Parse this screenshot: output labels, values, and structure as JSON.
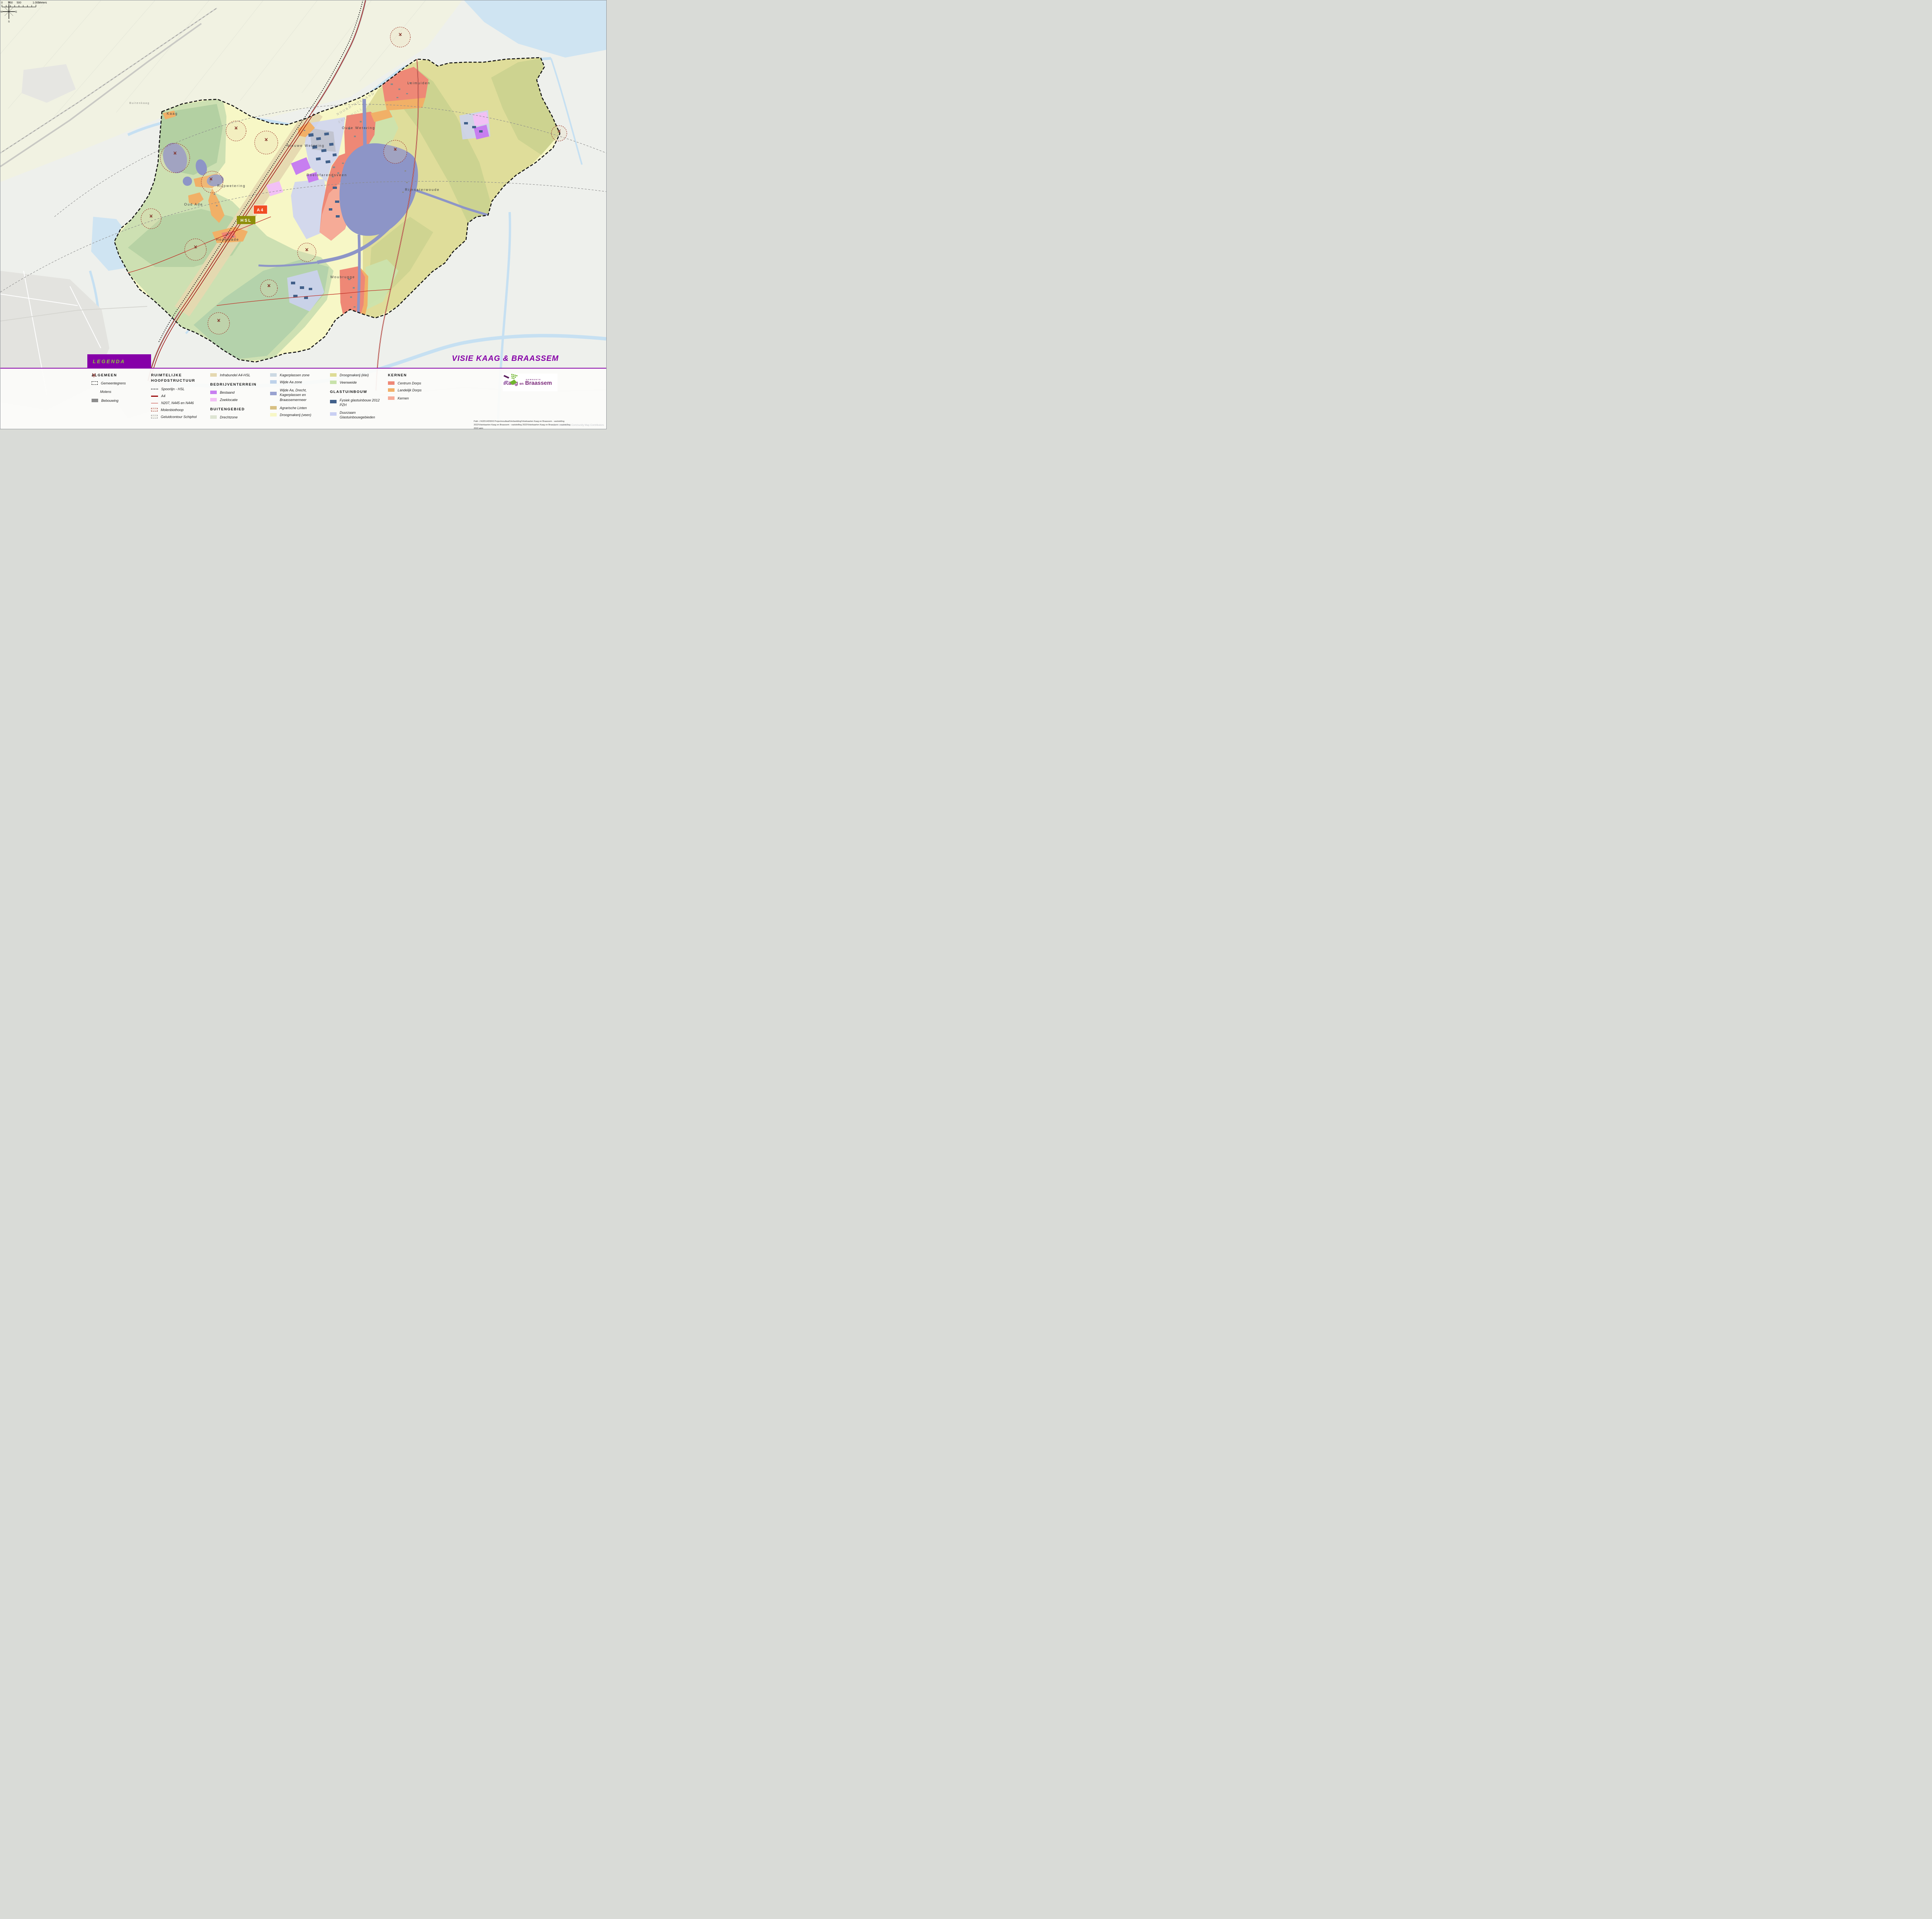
{
  "title": "VISIE KAAG & BRAASSEM",
  "legend": {
    "title": "LEGENDA",
    "col1": {
      "header": "ALGEMEEN",
      "items": {
        "gemeentegrens": "Gemeentegrens",
        "molens": "Molens",
        "bebouwing": "Bebouwing"
      }
    },
    "col2": {
      "header": "RUIMTELIJKE HOOFDSTRUCTUUR",
      "items": {
        "spoorlijn": "Spoorlijn - HSL",
        "a4": "A4",
        "nroads": "N207, N445 en N446",
        "molenbiothoop": "Molenbiothoop",
        "geluidcontour": "Geluidcontour Schiphol"
      }
    },
    "col3": {
      "infrabundel": "Infrabundel A4-HSL",
      "header_bedrijventerrein": "BEDRIJVENTERREIN",
      "bestaand": "Bestaand",
      "zoeklocatie": "Zoeklocatie",
      "header_buitengebied": "BUITENGEBIED",
      "drechtzone": "Drechtzone"
    },
    "col4": {
      "kagerplassen_zone": "Kagerplassen zone",
      "wijde_aa_zone": "Wijde Aa zone",
      "wijde_aa_drecht": "Wijde Aa, Drecht, Kagerplassen en Braassemermeer",
      "agrarische_linten": "Agrarische Linten",
      "droogmakerij_veen": "Droogmakerij (veen)"
    },
    "col5": {
      "droogmakerij_klei": "Droogmakerij (klei)",
      "veenweide": "Veenweide",
      "header_glastuinbouw": "GLASTUINBOUW",
      "fysiek": "Fysiek glastuinbouw 2012 PZH",
      "duurzaam": "Duurzaam Glastuinbouwgebieden"
    },
    "col6": {
      "header": "KERNEN",
      "centrum_dorps": "Centrum Dorps",
      "landelijk_dorps": "Landelijk Dorps",
      "kernen": "Kernen"
    }
  },
  "colors": {
    "accent_purple": "#8600a8",
    "legenda_text_green": "#8dc63f",
    "gemeentegrens": "#1a1a1a",
    "molens": "#8c3a34",
    "bebouwing": "#8c8c8c",
    "spoorlijn": "#1a1a1a",
    "a4_road": "#9c0b0b",
    "n_roads": "#c03026",
    "molenbiothoop_fill": "#f7ece6",
    "molenbiothoop_border": "#a03c32",
    "geluidcontour_fill": "#f0f0ea",
    "geluidcontour_border": "#8a8a8a",
    "infrabundel": "#e5d8b0",
    "bestaand": "#c77ef0",
    "zoeklocatie": "#f2c0f5",
    "drechtzone": "#dde4d2",
    "kagerplassen_zone": "#ccd9e3",
    "wijde_aa_zone": "#bdd2ea",
    "wijde_aa_drecht": "#99a2d0",
    "agrarische_linten": "#d8c083",
    "droogmakerij_veen": "#f7f7c6",
    "droogmakerij_klei": "#dedc96",
    "veenweide": "#c8e2aa",
    "fysiek_glastuinbouw": "#41608a",
    "duurzaam_glastuinbouw": "#c9cff2",
    "centrum_dorps": "#ee8876",
    "landelijk_dorps": "#f1b067",
    "kernen": "#f6ab97",
    "badge_a4": "#f04d23",
    "badge_hsl": "#8e8f0a",
    "water": "#cfe4f2",
    "lake_purple": "#8d95c7"
  },
  "map": {
    "badges": {
      "a4": "A4",
      "hsl": "HSL"
    },
    "labels": {
      "kaag": "Kaag",
      "buitenkaag": "Buitenkaag",
      "oud_ade": "Oud Ade",
      "rijpwetering": "Rijpwetering",
      "nieuwe_wetering": "Nieuwe Wetering",
      "oude_wetering": "Oude Wetering",
      "roelofarendsveen": "Roelofarendsveen",
      "leimuiden": "Leimuiden",
      "rijnsaterwoude": "Rijnsaterwoude",
      "woubrugge": "Woubrugge",
      "hoogmade": "Hoogmade",
      "noord_holland": "NOORD-HOLLAND",
      "zuid_holland": "ZUID-HOLLAND"
    },
    "attribution": "Esri Nederland, Community Map Contributors"
  },
  "logo": {
    "gemeente": "GEMEENTE",
    "kaag": "Kaag",
    "en": "en",
    "braassem": "Braassem"
  },
  "scalebar": {
    "t0": "0",
    "t250": "250",
    "t500": "500",
    "t1000": "1.000",
    "unit": "Meters"
  },
  "compass": {
    "n": "N",
    "e": "E",
    "s": "S",
    "w": "W"
  },
  "footer": {
    "path_line": "Path: J:\\620\\143\\50\\3 Projectresultaat\\Verbeelding\\Visiekaarten Kaag en Braassem - vaststelling 2022\\Visiekaarten Kaag en Braassem - vaststelling 2022\\Visiekaarten Kaag en Braassem - vaststelling 2022.aprx"
  }
}
